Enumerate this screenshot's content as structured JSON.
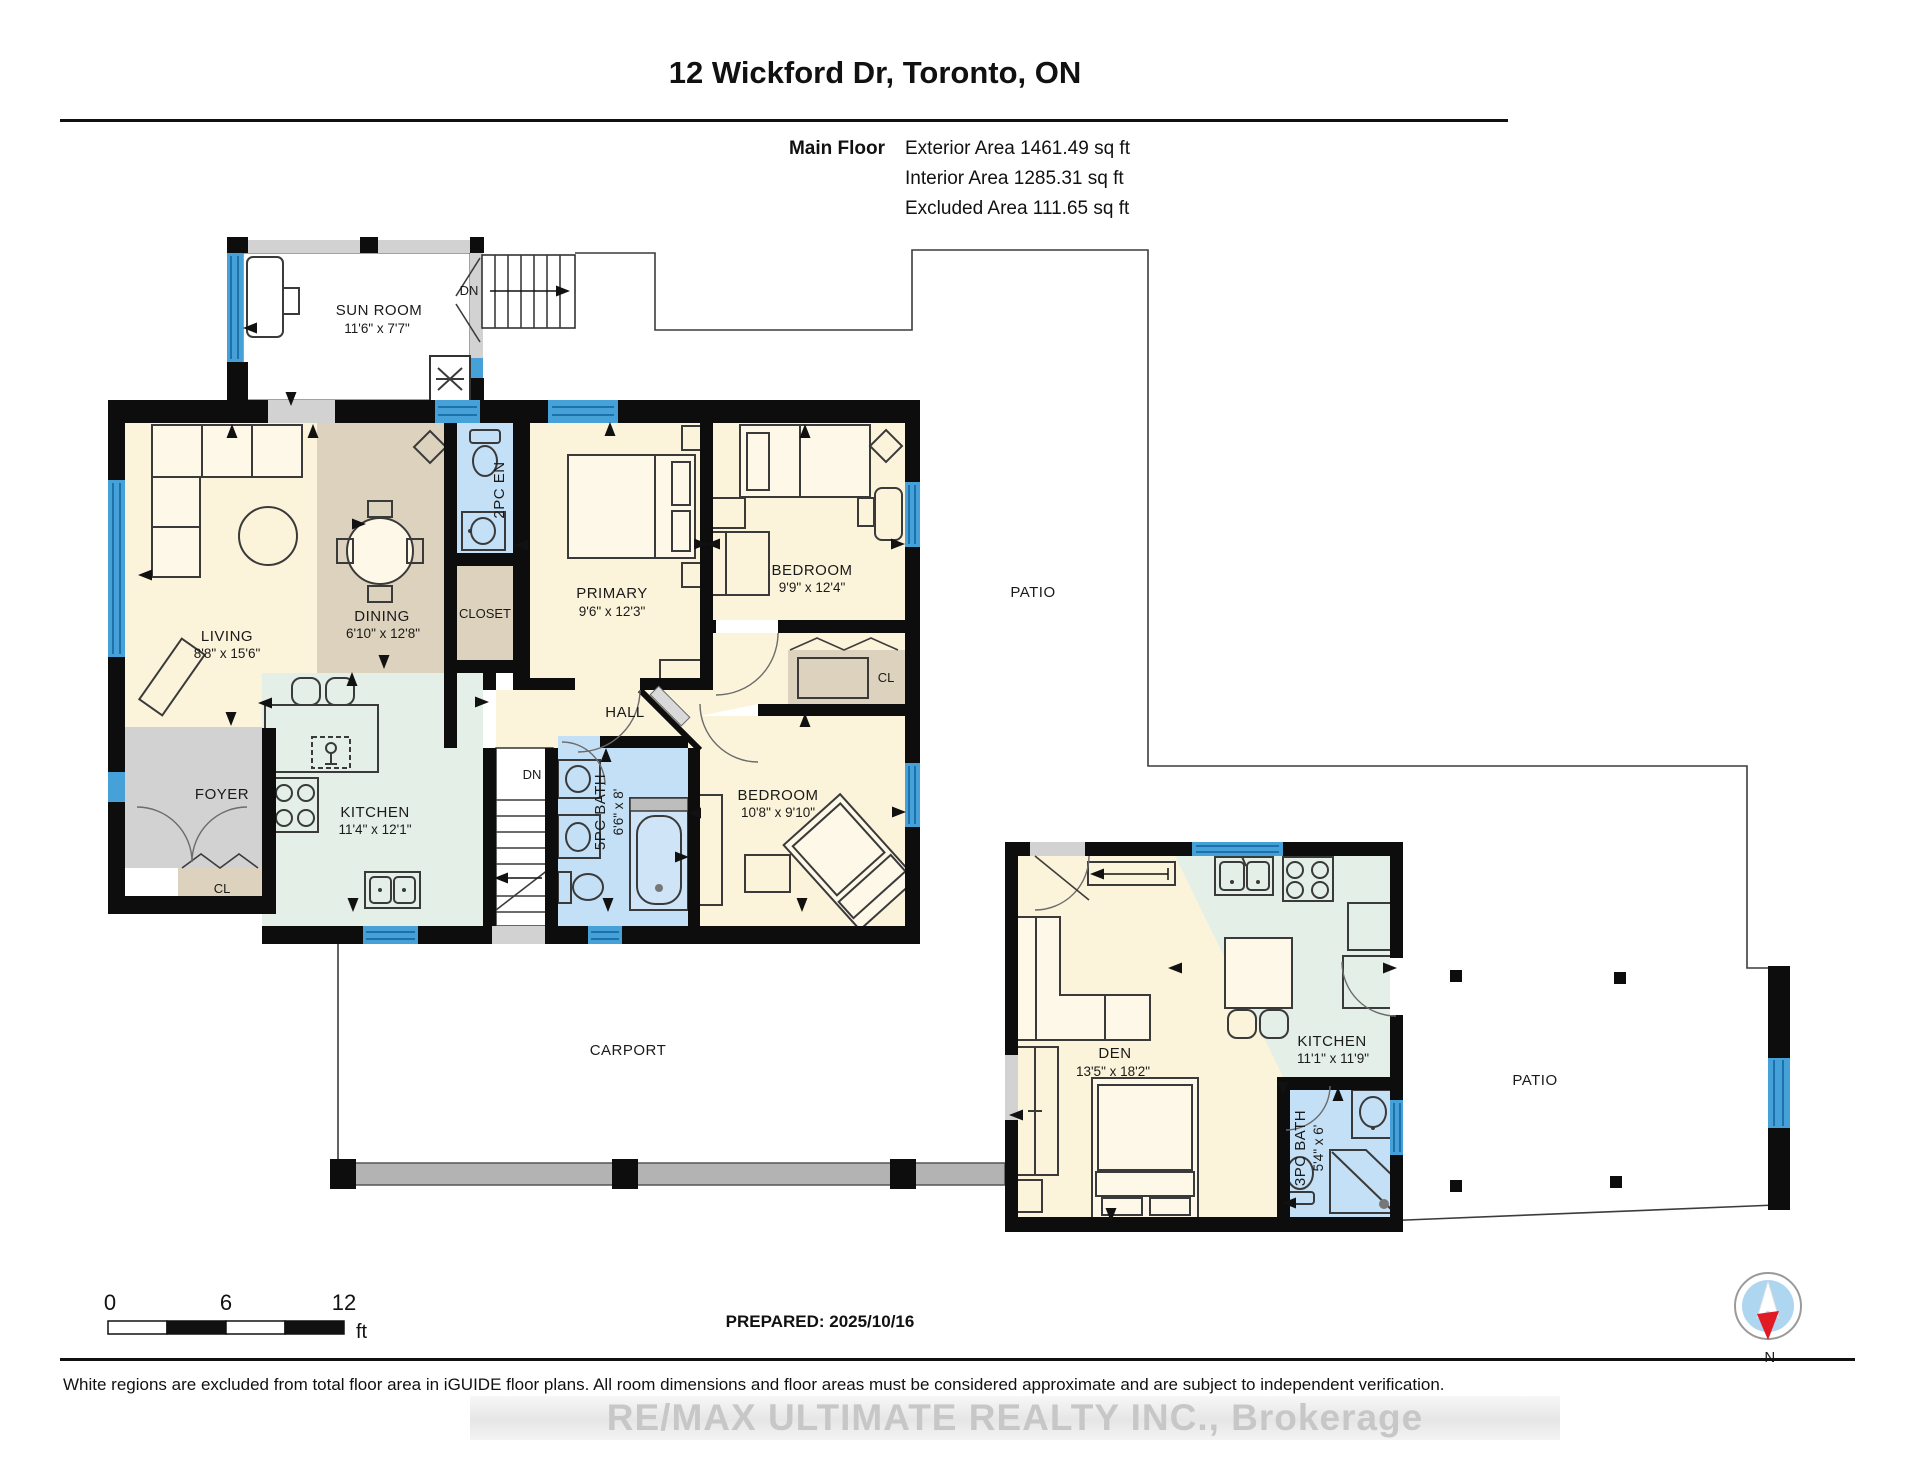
{
  "header": {
    "title": "12 Wickford Dr, Toronto, ON",
    "floor_label": "Main Floor",
    "exterior_area": "Exterior Area 1461.49 sq ft",
    "interior_area": "Interior Area 1285.31 sq ft",
    "excluded_area": "Excluded Area 111.65 sq ft"
  },
  "rooms": {
    "sun_room": {
      "name": "SUN ROOM",
      "dims": "11'6\" x 7'7\""
    },
    "living": {
      "name": "LIVING",
      "dims": "8'8\" x 15'6\""
    },
    "dining": {
      "name": "DINING",
      "dims": "6'10\" x 12'8\""
    },
    "two_pc_en": {
      "name": "2PC EN"
    },
    "closet": {
      "name": "CLOSET"
    },
    "primary": {
      "name": "PRIMARY",
      "dims": "9'6\" x 12'3\""
    },
    "bedroom2": {
      "name": "BEDROOM",
      "dims": "9'9\" x 12'4\""
    },
    "hall": {
      "name": "HALL"
    },
    "cl_hall": {
      "name": "CL"
    },
    "foyer": {
      "name": "FOYER"
    },
    "cl_foyer": {
      "name": "CL"
    },
    "kitchen": {
      "name": "KITCHEN",
      "dims": "11'4\" x 12'1\""
    },
    "bath5": {
      "name": "5PC BATH",
      "dims": "6'6\" x 8'"
    },
    "bedroom3": {
      "name": "BEDROOM",
      "dims": "10'8\" x 9'10\""
    },
    "den": {
      "name": "DEN",
      "dims": "13'5\" x 18'2\""
    },
    "kitchen2": {
      "name": "KITCHEN",
      "dims": "11'1\" x 11'9\""
    },
    "bath3": {
      "name": "3PC BATH",
      "dims": "5'4\" x 6'"
    },
    "carport": {
      "name": "CARPORT"
    },
    "patio_upper": {
      "name": "PATIO"
    },
    "patio_lower": {
      "name": "PATIO"
    },
    "stairs_upper_label": "DN",
    "stairs_main_label": "DN"
  },
  "footer": {
    "scale": {
      "t0": "0",
      "t6": "6",
      "t12": "12",
      "unit": "ft"
    },
    "prepared": "PREPARED: 2025/10/16",
    "compass": "N",
    "disclaimer": "White regions are excluded from total floor area in iGUIDE floor plans. All room dimensions and floor areas must be considered approximate and are subject to independent verification.",
    "watermark": "RE/MAX ULTIMATE REALTY INC., Brokerage"
  },
  "colors": {
    "wall": "#0d0d0d",
    "window": "#45a1d8",
    "window_stripe": "#1e72ab",
    "room_cream": "#fcf4da",
    "room_tan": "#ddd2bd",
    "room_mint": "#e4efe8",
    "room_bath_blue": "#c4e0f6",
    "room_gray": "#d2d2d2",
    "carport_band": "#b3b3b3",
    "compass_needle_red": "#e01b24",
    "compass_disc_blue": "#aed6f1",
    "watermark_gray": "#c7c7c7"
  }
}
